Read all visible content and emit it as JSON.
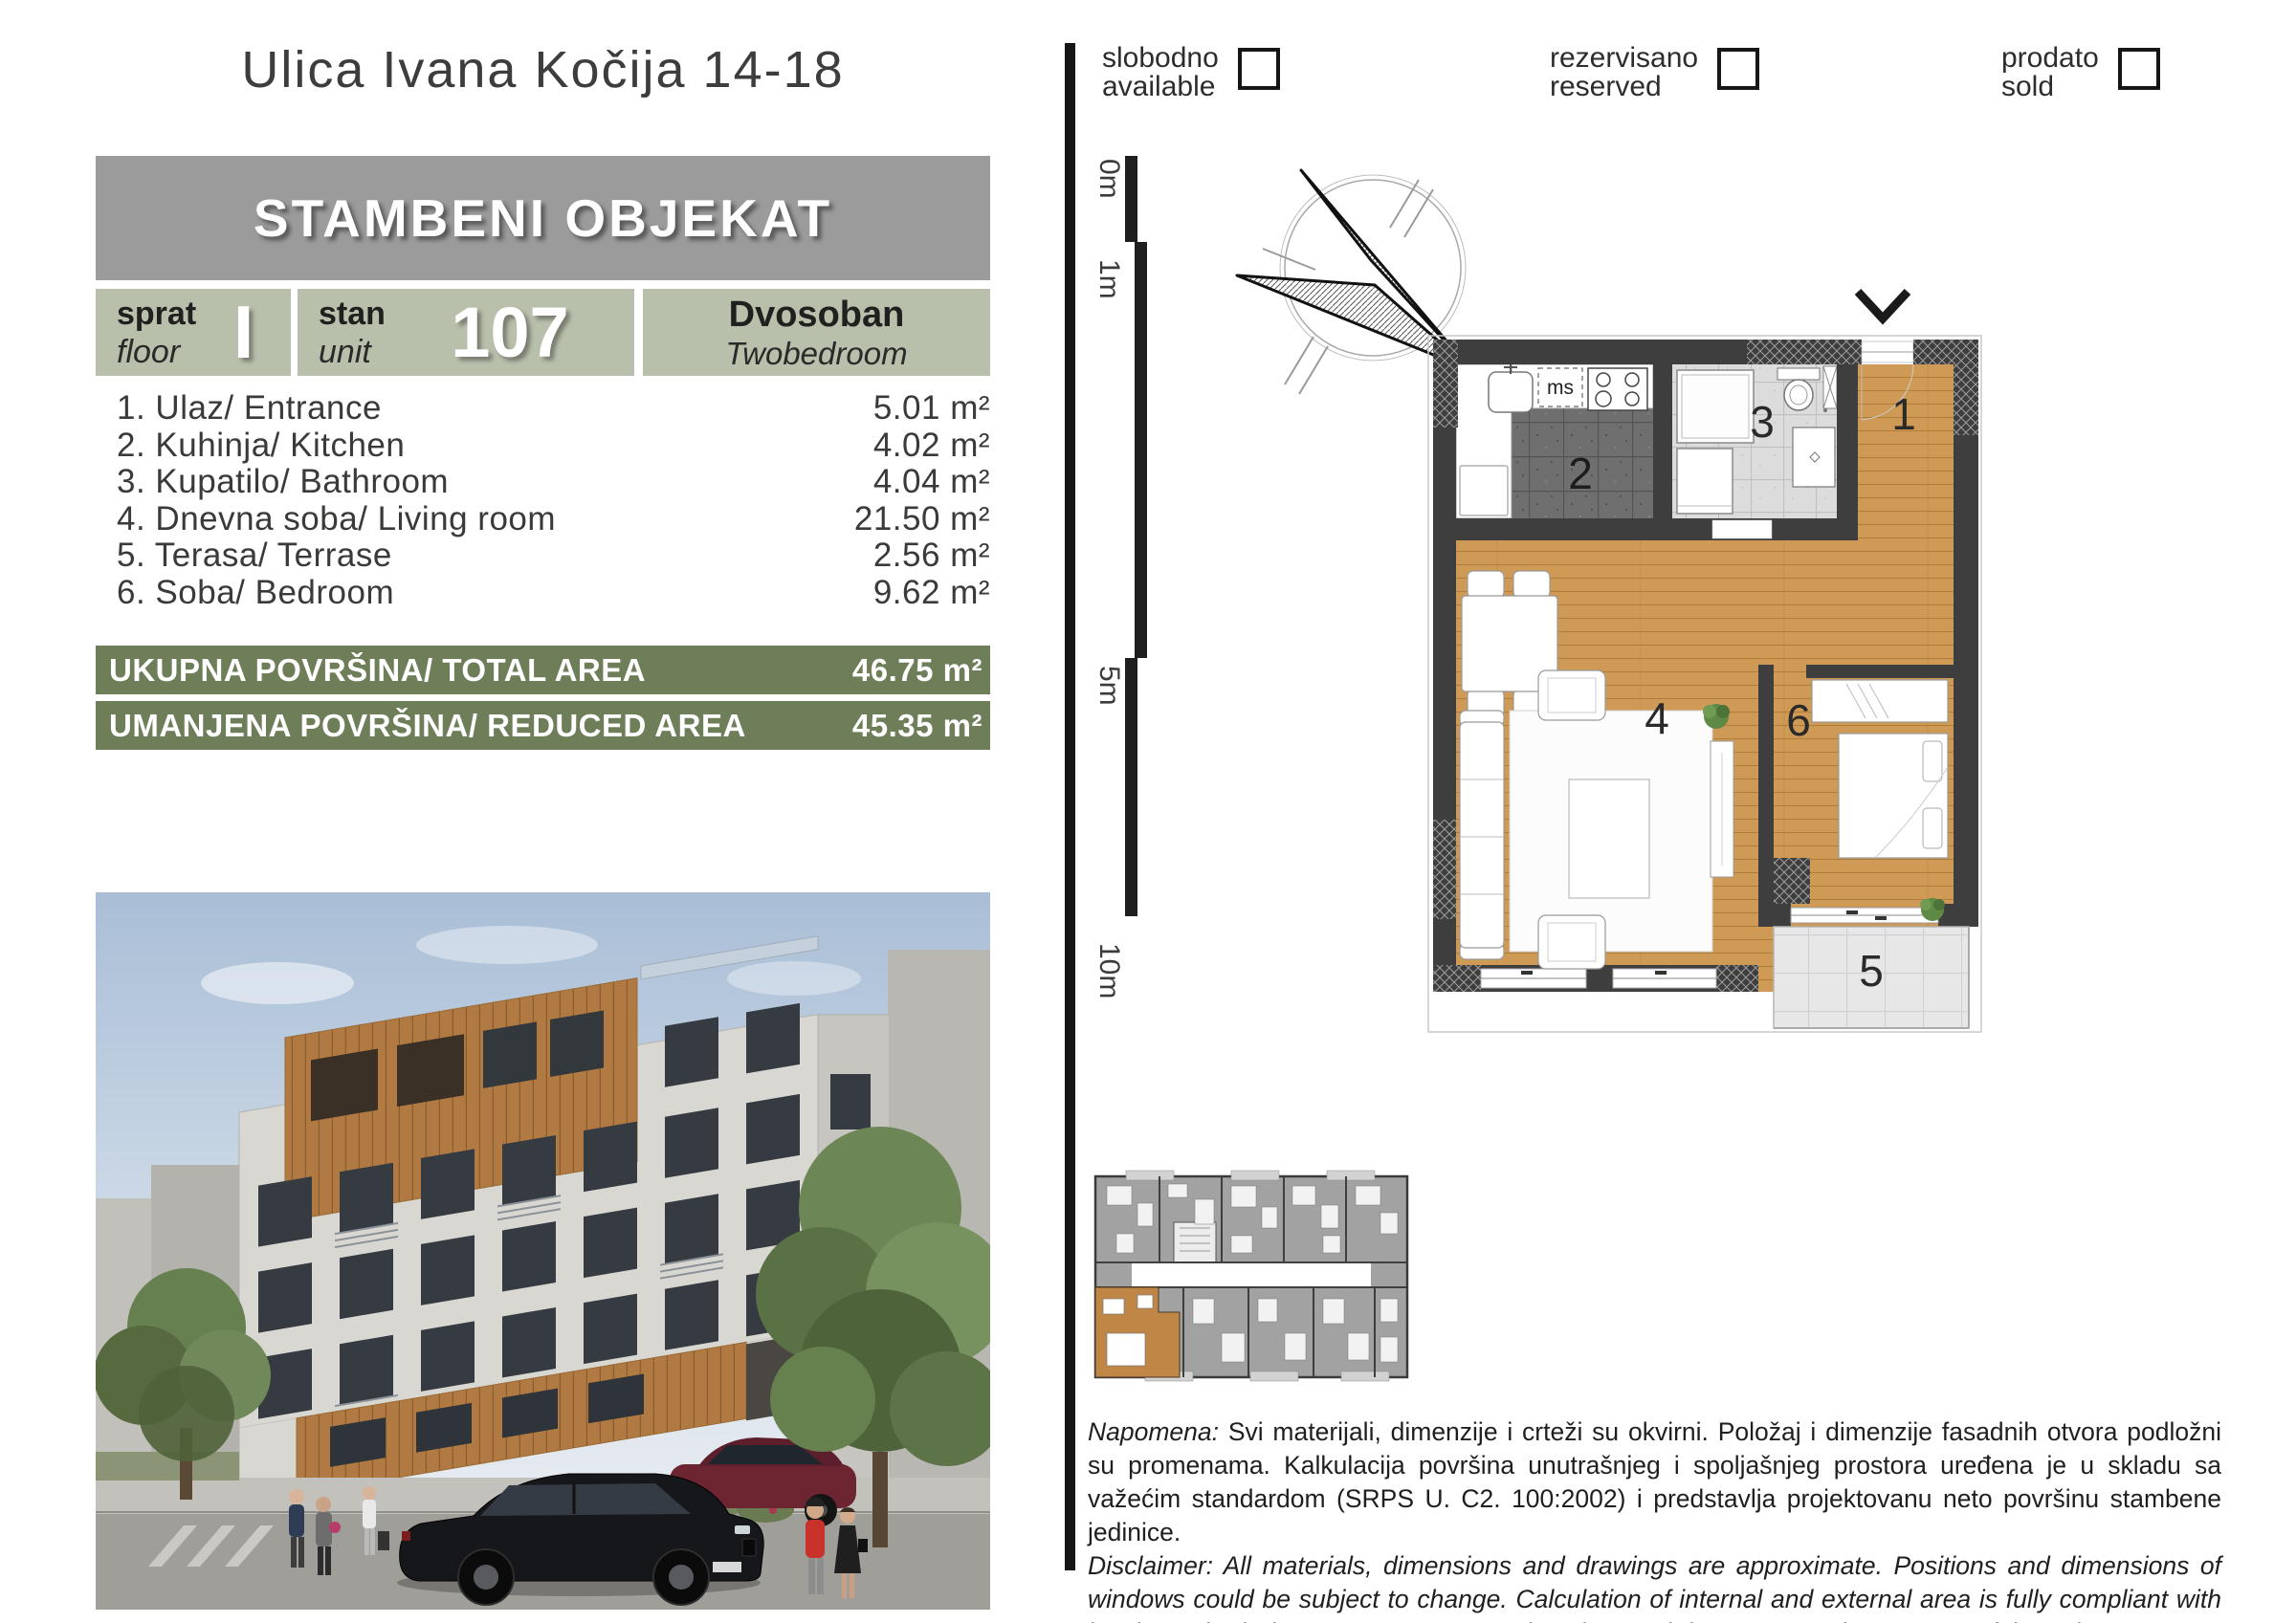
{
  "header": {
    "street_title": "Ulica Ivana Kočija 14-18",
    "building_banner": "STAMBENI OBJEKAT"
  },
  "unit": {
    "floor": {
      "label_sr": "sprat",
      "label_en": "floor",
      "value": "I"
    },
    "number": {
      "label_sr": "stan",
      "label_en": "unit",
      "value": "107"
    },
    "type": {
      "label_sr": "Dvosoban",
      "label_en": "Twobedroom"
    }
  },
  "rooms": [
    {
      "label": "1. Ulaz/ Entrance",
      "area": "5.01 m²"
    },
    {
      "label": "2. Kuhinja/ Kitchen",
      "area": "4.02 m²"
    },
    {
      "label": "3. Kupatilo/ Bathroom",
      "area": "4.04 m²"
    },
    {
      "label": "4. Dnevna soba/ Living room",
      "area": "21.50 m²"
    },
    {
      "label": "5. Terasa/ Terrase",
      "area": "2.56 m²"
    },
    {
      "label": "6. Soba/ Bedroom",
      "area": "9.62 m²"
    }
  ],
  "totals": [
    {
      "label": "UKUPNA POVRŠINA/ TOTAL AREA",
      "value": "46.75 m²"
    },
    {
      "label": "UMANJENA POVRŠINA/ REDUCED AREA",
      "value": "45.35 m²"
    }
  ],
  "legend": [
    {
      "sr": "slobodno",
      "en": "available"
    },
    {
      "sr": "rezervisano",
      "en": "reserved"
    },
    {
      "sr": "prodato",
      "en": "sold"
    }
  ],
  "scale_bar": {
    "labels": [
      "0m",
      "1m",
      "5m",
      "10m"
    ]
  },
  "compass": {
    "north_label": "sever"
  },
  "floor_plan": {
    "kitchen_appliance_label": "ms",
    "room_numbers": {
      "entrance": "1",
      "kitchen": "2",
      "bathroom": "3",
      "living": "4",
      "terrace": "5",
      "bedroom": "6"
    }
  },
  "notes": {
    "napomena_label": "Napomena:",
    "napomena_text": " Svi materijali, dimenzije i crteži su okvirni. Položaj i dimenzije fasadnih otvora podložni su promenama. Kalkulacija površina unutrašnjeg i spoljašnjeg prostora uređena je u skladu sa važećim standardom (SRPS U. C2. 100:2002) i predstavlja projektovanu neto površinu stambene jedinice.",
    "disclaimer_label": "Disclaimer:",
    "disclaimer_text": " All materials, dimensions and drawings are approximate. Positions and dimensions of windows could be subject to change. Calculation of internal and external area is fully compliant with local standards (SRPS U. C2.100:2002) and as such it represents the net area of the unit."
  },
  "colors": {
    "sage_block": "#b8bfab",
    "olive_bar": "#6e7e58",
    "banner_gray": "#9c9b9b",
    "wood_floor": "#cf9a55",
    "wall_dark": "#3e3e3e",
    "highlighted_unit": "#c08646"
  }
}
